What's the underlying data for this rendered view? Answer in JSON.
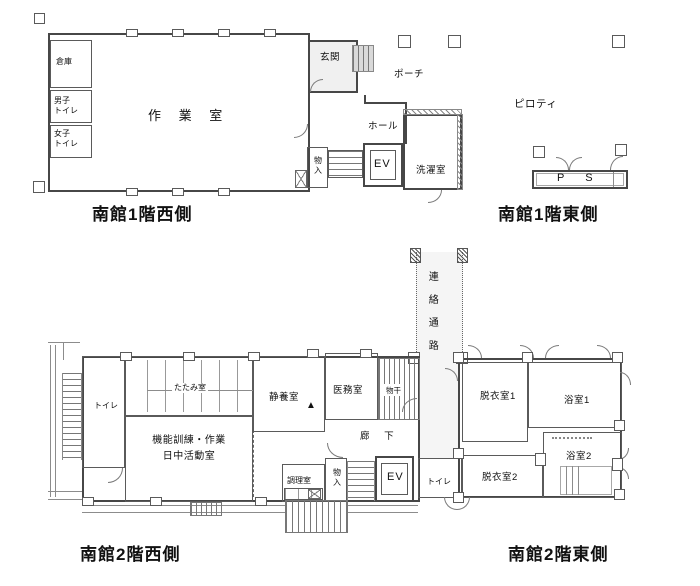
{
  "colors": {
    "wall": "#474747",
    "thin_line": "#999999",
    "text": "#111111",
    "entry_fill": "#f0f0f0",
    "corridor_fill": "#f5f5f5"
  },
  "plans": {
    "f1w": {
      "caption": "南館1階西側",
      "labels": {
        "souko": "倉庫",
        "danshi": "男子\nトイレ",
        "joshi": "女子\nトイレ",
        "sagyo": "作 業 室",
        "genkan": "玄関",
        "porch": "ポーチ",
        "hall": "ホール",
        "monoire": "物\n入",
        "ev": "EV",
        "sentaku": "洗濯室"
      }
    },
    "f1e": {
      "caption": "南館1階東側",
      "labels": {
        "piloti": "ピロティ",
        "ps": "P S"
      }
    },
    "f2w": {
      "caption": "南館2階西側",
      "labels": {
        "toire": "トイレ",
        "tatami": "たたみ室",
        "katsudo": "機能訓練・作業\n日中活動室",
        "seiyo": "静養室",
        "marker": "▲",
        "imu": "医務室",
        "monohoshi": "物干",
        "roka": "廊 下",
        "chori": "調理室",
        "monoire": "物\n入",
        "ev": "EV"
      }
    },
    "f2e": {
      "caption": "南館2階東側",
      "labels": {
        "renraku": "連\n絡\n通\n路",
        "datsui1": "脱衣室1",
        "yoku1": "浴室1",
        "yoku2": "浴室2",
        "datsui2": "脱衣室2",
        "toire": "トイレ"
      }
    }
  }
}
